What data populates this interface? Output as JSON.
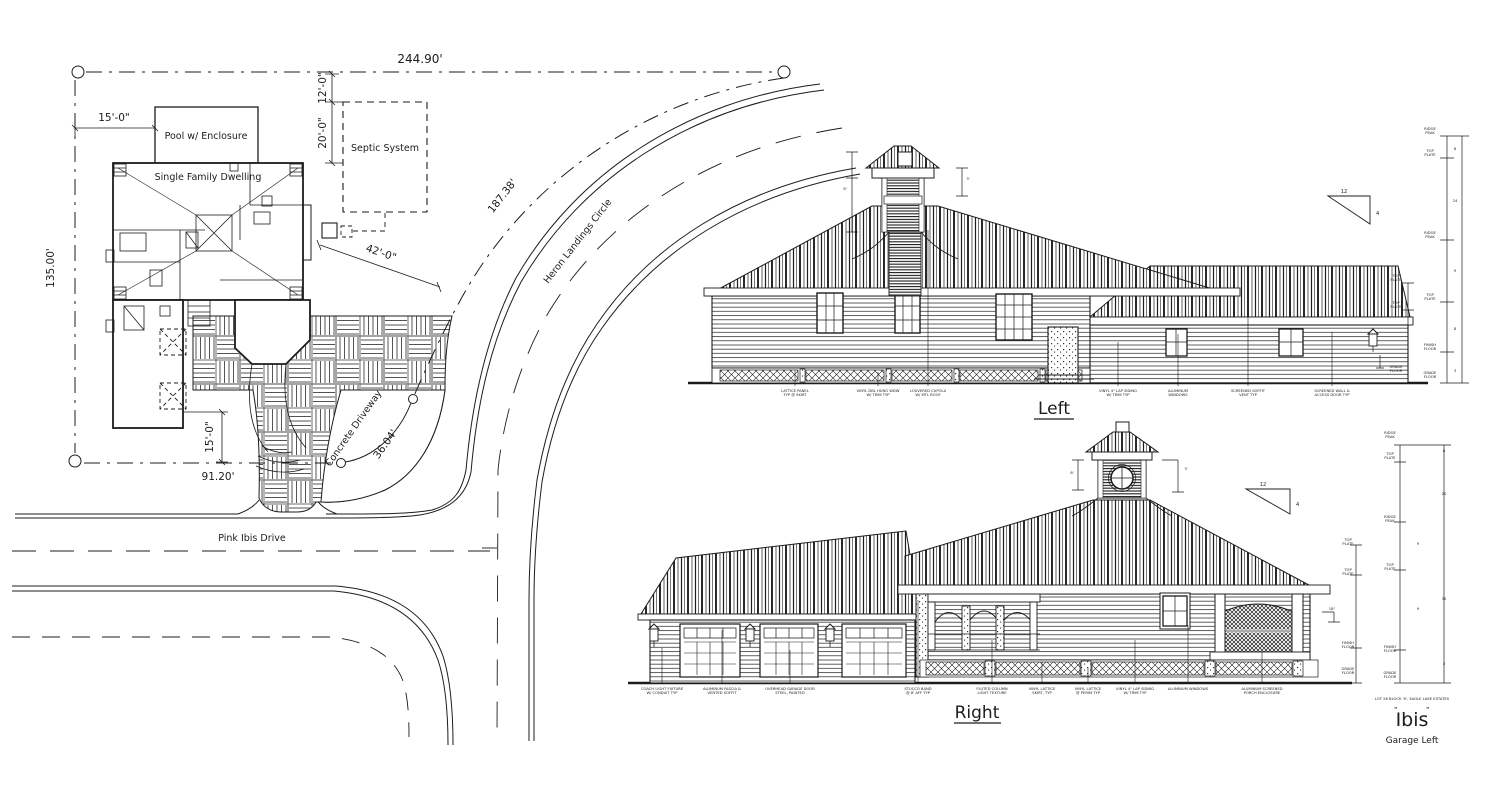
{
  "sheet": {
    "type": "Residential site plan with left and right building elevations"
  },
  "site_plan": {
    "dimensions": {
      "front_width": "244.90'",
      "side_depth": "135.00'",
      "pool_setback": "15'-0\"",
      "septic_width": "12'-0\"",
      "septic_depth": "20'-0\"",
      "house_to_street": "42'-0\"",
      "street_curve_length": "187.38'",
      "drive_curve_length": "36.04'",
      "front_segment": "91.20'",
      "drive_setback": "15'-0\""
    },
    "labels": {
      "pool": "Pool w/ Enclosure",
      "dwelling": "Single Family Dwelling",
      "septic": "Septic System",
      "driveway": "Concrete Driveway",
      "curved_street": "Heron Landings Circle",
      "bottom_street": "Pink Ibis Drive"
    }
  },
  "elevations": {
    "left": {
      "title": "Left",
      "pitch": {
        "run": "12",
        "rise": "4"
      },
      "callouts": [
        {
          "x": 795,
          "ty": 370,
          "lines": [
            "LATTICE PANEL",
            "TYP @ SKIRT"
          ]
        },
        {
          "x": 878,
          "ty": 372,
          "lines": [
            "VINYL DBL HUNG WDW",
            "W/ TRIM TYP"
          ]
        },
        {
          "x": 928,
          "ty": 230,
          "lines": [
            "LOUVERED CUPOLA",
            "W/ MTL ROOF"
          ]
        },
        {
          "x": 1118,
          "ty": 342,
          "lines": [
            "VINYL 4\" LAP SIDING",
            "W/ TRIM TYP"
          ]
        },
        {
          "x": 1178,
          "ty": 334,
          "lines": [
            "ALUMINUM",
            "WINDOWS"
          ]
        },
        {
          "x": 1248,
          "ty": 302,
          "lines": [
            "SCREENED SOFFIT",
            "VENT TYP"
          ]
        },
        {
          "x": 1332,
          "ty": 332,
          "lines": [
            "SCREENED WALL &",
            "ACCESS DOOR TYP"
          ]
        }
      ],
      "dims": [
        {
          "x": 1430,
          "y": 130,
          "lines": [
            "RIDGE",
            "PEAK"
          ]
        },
        {
          "x": 1430,
          "y": 152,
          "lines": [
            "TOP",
            "PLATE"
          ]
        },
        {
          "x": 1430,
          "y": 234,
          "lines": [
            "RIDGE",
            "PEAK"
          ]
        },
        {
          "x": 1396,
          "y": 277,
          "lines": [
            "TOP",
            "PLATE"
          ]
        },
        {
          "x": 1430,
          "y": 296,
          "lines": [
            "TOP",
            "PLATE"
          ]
        },
        {
          "x": 1396,
          "y": 304,
          "lines": [
            "TOP",
            "PLATE"
          ]
        },
        {
          "x": 1430,
          "y": 346,
          "lines": [
            "FINISH",
            "FLOOR"
          ]
        },
        {
          "x": 1396,
          "y": 368,
          "lines": [
            "GRADE",
            "FLOOR"
          ]
        },
        {
          "x": 1430,
          "y": 374,
          "lines": [
            "GRADE",
            "FLOOR"
          ]
        },
        {
          "x": 1455,
          "y": 150,
          "lines": [
            "8"
          ]
        },
        {
          "x": 1455,
          "y": 202,
          "lines": [
            "24"
          ]
        },
        {
          "x": 1455,
          "y": 272,
          "lines": [
            "9"
          ]
        },
        {
          "x": 1455,
          "y": 330,
          "lines": [
            "8"
          ]
        },
        {
          "x": 1455,
          "y": 372,
          "lines": [
            "3"
          ]
        },
        {
          "x": 845,
          "y": 190,
          "lines": [
            "8'"
          ]
        },
        {
          "x": 968,
          "y": 180,
          "lines": [
            "3'"
          ]
        }
      ]
    },
    "right": {
      "title": "Right",
      "pitch": {
        "run": "12",
        "rise": "4"
      },
      "callouts": [
        {
          "x": 662,
          "ty": 648,
          "lines": [
            "COACH LIGHT FIXTURE",
            "W/ CONDUIT TYP"
          ]
        },
        {
          "x": 722,
          "ty": 630,
          "lines": [
            "ALUMINUM FASCIA &",
            "VENTED SOFFIT"
          ]
        },
        {
          "x": 790,
          "ty": 650,
          "lines": [
            "OVERHEAD GARAGE DOOR",
            "STEEL, PAINTED"
          ]
        },
        {
          "x": 918,
          "ty": 600,
          "lines": [
            "STUCCO BAND",
            "@ 8' AFF TYP"
          ]
        },
        {
          "x": 992,
          "ty": 640,
          "lines": [
            "FLUTED COLUMN",
            "LIGHT TEXTURE"
          ]
        },
        {
          "x": 1042,
          "ty": 662,
          "lines": [
            "VINYL LATTICE",
            "SKIRT, TYP"
          ]
        },
        {
          "x": 1088,
          "ty": 668,
          "lines": [
            "VINYL LATTICE",
            "@ PERIM TYP"
          ]
        },
        {
          "x": 1135,
          "ty": 640,
          "lines": [
            "VINYL 4\" LAP SIDING",
            "W/ TRIM TYP"
          ]
        },
        {
          "x": 1188,
          "ty": 625,
          "lines": [
            "ALUMINUM WINDOWS"
          ]
        },
        {
          "x": 1262,
          "ty": 652,
          "lines": [
            "ALUMINUM SCREENED",
            "PORCH ENCLOSURE"
          ]
        }
      ],
      "dims": [
        {
          "x": 1390,
          "y": 434,
          "lines": [
            "RIDGE",
            "PEAK"
          ]
        },
        {
          "x": 1390,
          "y": 455,
          "lines": [
            "TOP",
            "PLATE"
          ]
        },
        {
          "x": 1390,
          "y": 518,
          "lines": [
            "RIDGE",
            "PEAK"
          ]
        },
        {
          "x": 1390,
          "y": 566,
          "lines": [
            "TOP",
            "PLATE"
          ]
        },
        {
          "x": 1348,
          "y": 541,
          "lines": [
            "TOP",
            "PLATE"
          ]
        },
        {
          "x": 1348,
          "y": 571,
          "lines": [
            "TOP",
            "PLATE"
          ]
        },
        {
          "x": 1348,
          "y": 644,
          "lines": [
            "FINISH",
            "FLOOR"
          ]
        },
        {
          "x": 1390,
          "y": 648,
          "lines": [
            "FINISH",
            "FLOOR"
          ]
        },
        {
          "x": 1348,
          "y": 670,
          "lines": [
            "GRADE",
            "FLOOR"
          ]
        },
        {
          "x": 1390,
          "y": 674,
          "lines": [
            "GRADE",
            "FLOOR"
          ]
        },
        {
          "x": 1444,
          "y": 452,
          "lines": [
            "8"
          ]
        },
        {
          "x": 1444,
          "y": 495,
          "lines": [
            "20"
          ]
        },
        {
          "x": 1444,
          "y": 600,
          "lines": [
            "30"
          ]
        },
        {
          "x": 1444,
          "y": 665,
          "lines": [
            "3"
          ]
        },
        {
          "x": 1418,
          "y": 545,
          "lines": [
            "9"
          ]
        },
        {
          "x": 1418,
          "y": 610,
          "lines": [
            "9"
          ]
        },
        {
          "x": 1332,
          "y": 610,
          "lines": [
            "18\""
          ]
        },
        {
          "x": 1072,
          "y": 474,
          "lines": [
            "8'"
          ]
        },
        {
          "x": 1186,
          "y": 470,
          "lines": [
            "3'"
          ]
        }
      ],
      "footer": {
        "lot_line": "LOT 26 BLOCK 'X', EAGLE LAKE ESTATES",
        "quote_mark": "”",
        "plan_name": "Ibis",
        "variant": "Garage Left"
      }
    }
  }
}
